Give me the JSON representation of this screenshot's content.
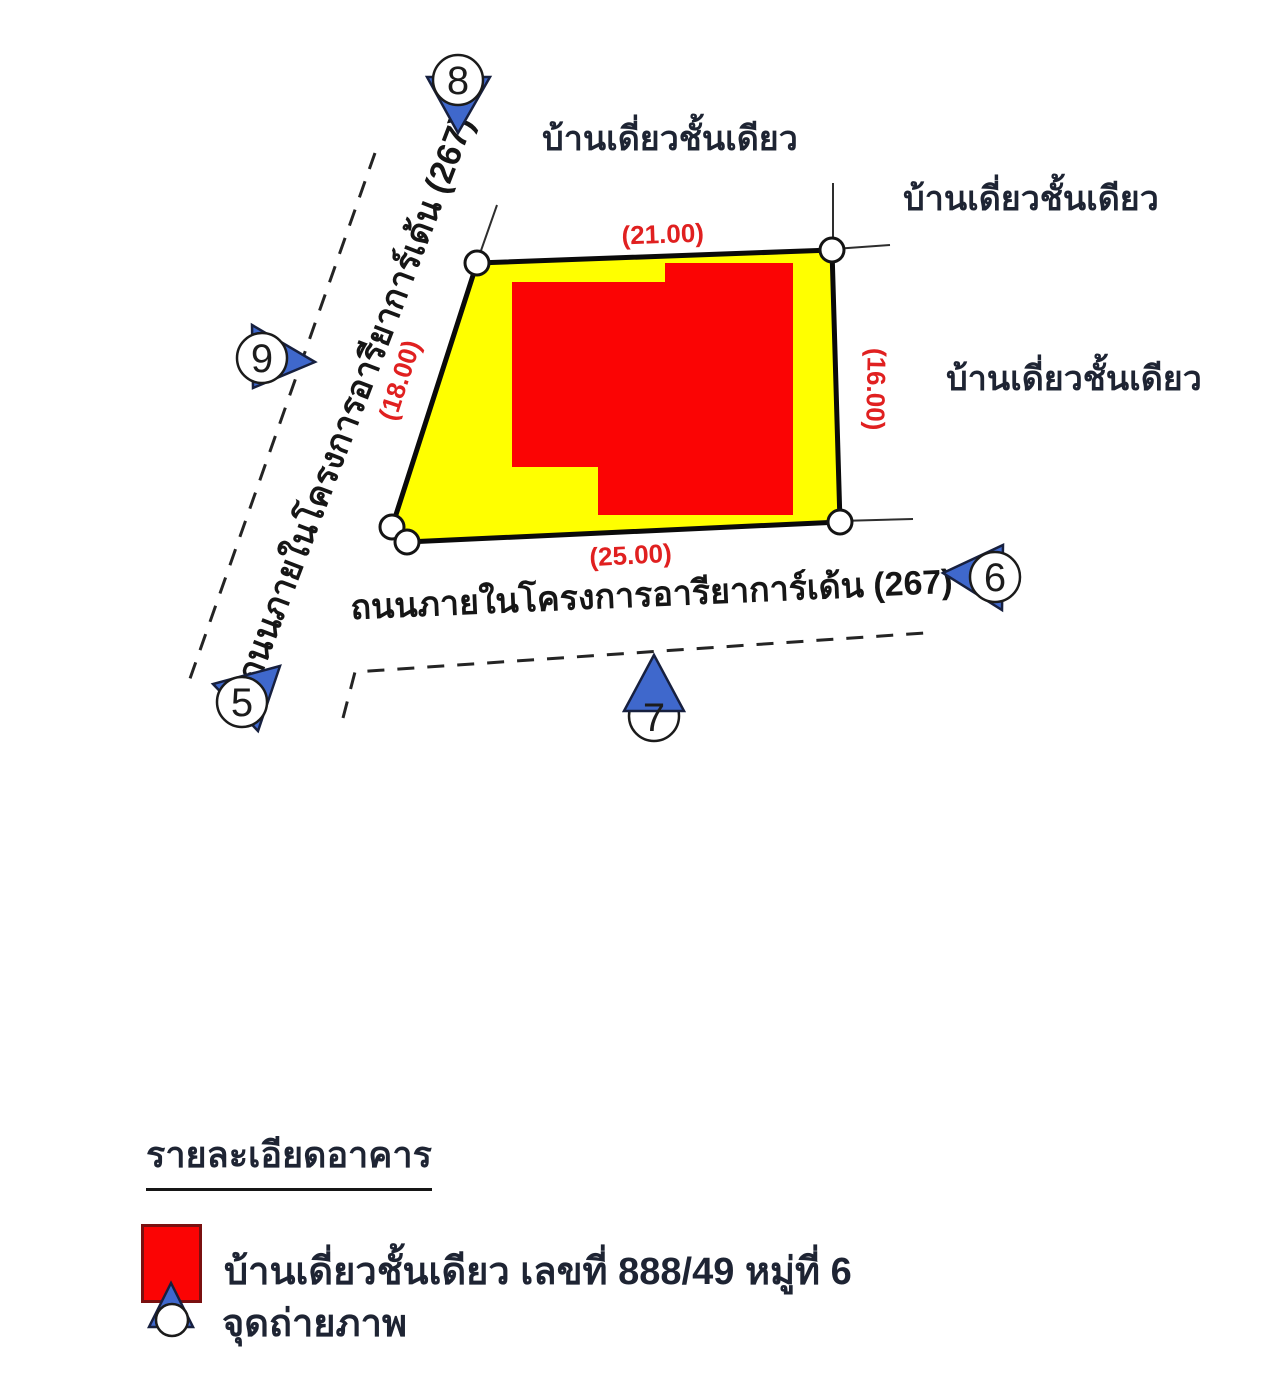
{
  "map": {
    "neighbors": {
      "top": "บ้านเดี่ยวชั้นเดียว",
      "right_upper": "บ้านเดี่ยวชั้นเดียว",
      "right_lower": "บ้านเดี่ยวชั้นเดียว"
    },
    "roads": {
      "left": "ถนนภายในโครงการอารียาการ์เด้น (267)",
      "bottom": "ถนนภายในโครงการอารียาการ์เด้น (267)"
    },
    "dimensions": {
      "top": "(21.00)",
      "left": "(18.00)",
      "right": "(16.00)",
      "bottom": "(25.00)"
    },
    "markers": [
      {
        "label": "8"
      },
      {
        "label": "9"
      },
      {
        "label": "5"
      },
      {
        "label": "7"
      },
      {
        "label": "6"
      }
    ]
  },
  "legend": {
    "title": "รายละเอียดอาคาร",
    "building_label": "บ้านเดี่ยวชั้นเดียว เลขที่ 888/49 หมู่ที่ 6",
    "photo_label": "จุดถ่ายภาพ"
  },
  "colors": {
    "plot_fill": "#ffff00",
    "building_fill": "#fb0404",
    "marker_blue": "#3f68cc",
    "dimension_red": "#e02020",
    "legend_square_red": "#fb0404"
  }
}
